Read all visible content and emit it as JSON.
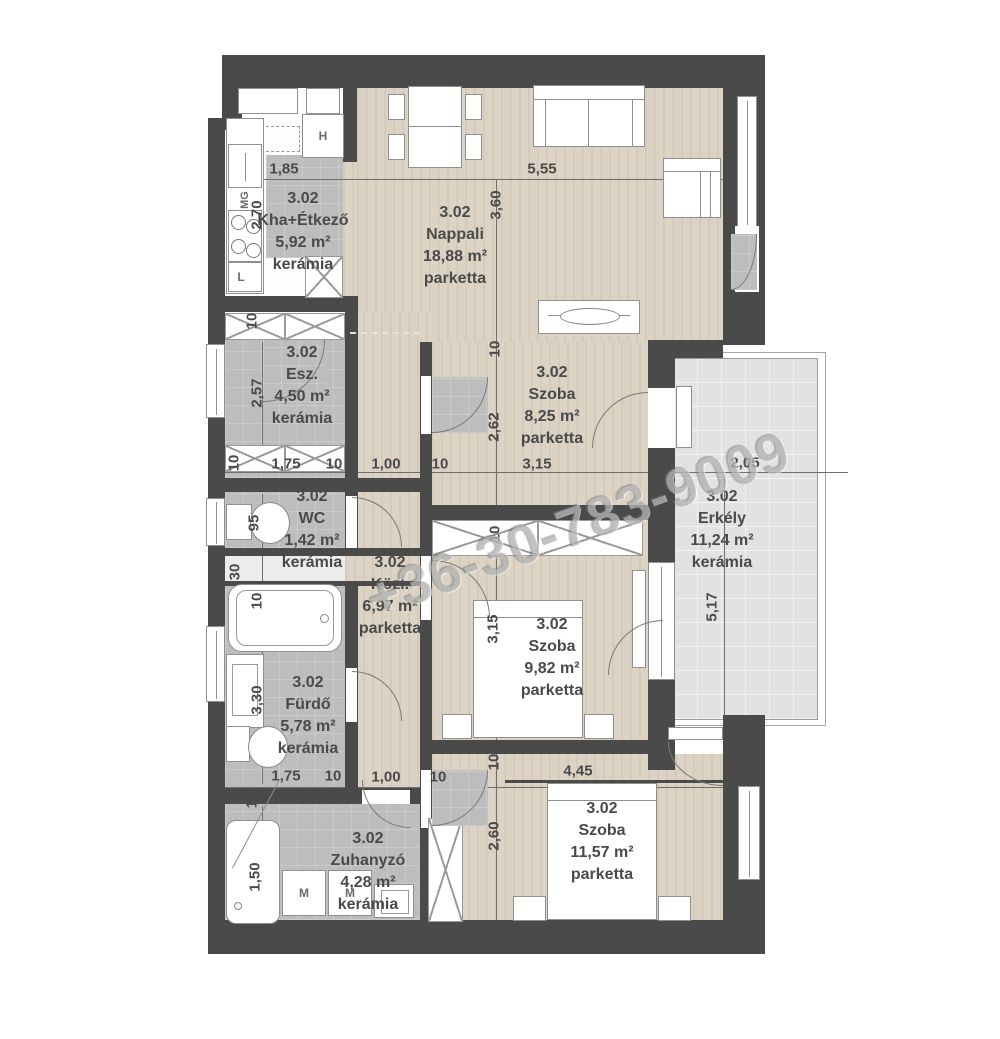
{
  "watermark": {
    "text": "+36-30-783-9009"
  },
  "rooms": {
    "kitchen": {
      "code": "3.02",
      "name": "Kha+Étkező",
      "area": "5,92 m²",
      "floor": "kerámia"
    },
    "nappali": {
      "code": "3.02",
      "name": "Nappali",
      "area": "18,88 m²",
      "floor": "parketta"
    },
    "esz": {
      "code": "3.02",
      "name": "Esz.",
      "area": "4,50 m²",
      "floor": "kerámia"
    },
    "wc": {
      "code": "3.02",
      "name": "WC",
      "area": "1,42 m²",
      "floor": "kerámia"
    },
    "kozl": {
      "code": "3.02",
      "name": "Közl.",
      "area": "6,97 m²",
      "floor": "parketta"
    },
    "furdo": {
      "code": "3.02",
      "name": "Fürdő",
      "area": "5,78 m²",
      "floor": "kerámia"
    },
    "zuhanyzo": {
      "code": "3.02",
      "name": "Zuhanyzó",
      "area": "4,28 m²",
      "floor": "kerámia"
    },
    "szoba1": {
      "code": "3.02",
      "name": "Szoba",
      "area": "8,25 m²",
      "floor": "parketta"
    },
    "szoba2": {
      "code": "3.02",
      "name": "Szoba",
      "area": "9,82 m²",
      "floor": "parketta"
    },
    "szoba3": {
      "code": "3.02",
      "name": "Szoba",
      "area": "11,57 m²",
      "floor": "parketta"
    },
    "erkely": {
      "code": "3.02",
      "name": "Erkély",
      "area": "11,24 m²",
      "floor": "kerámia"
    }
  },
  "dims": {
    "d185": "1,85",
    "d555": "5,55",
    "d270": "2,70",
    "d360": "3,60",
    "d262": "2,62",
    "d315": "3,15",
    "d260": "2,60",
    "d257": "2,57",
    "d95": "95",
    "d30": "30",
    "d330": "3,30",
    "d150": "1,50",
    "d175": "1,75",
    "d100": "1,00",
    "d10": "10",
    "d45": "45",
    "d205": "2,05",
    "d445": "4,45",
    "d517": "5,17"
  },
  "fixtures": {
    "mg": "MG",
    "fridge": "H",
    "washer": "M",
    "cabinet": "L"
  }
}
